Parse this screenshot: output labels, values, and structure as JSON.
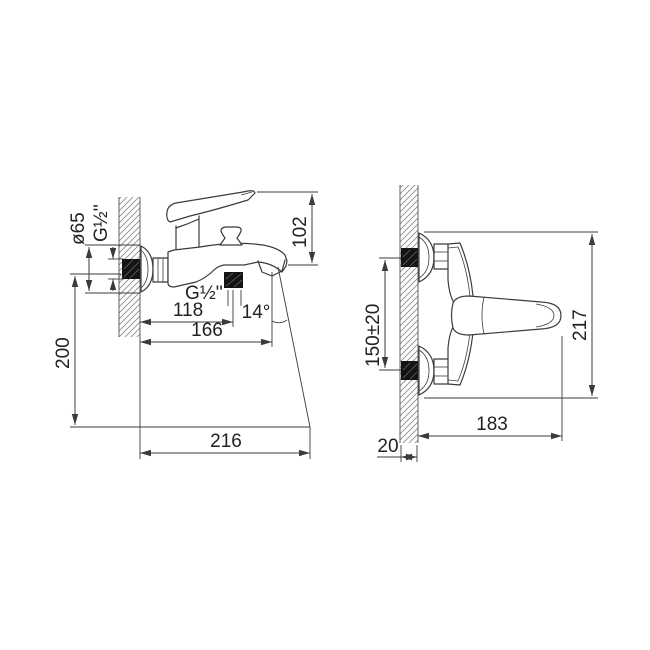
{
  "colors": {
    "background": "#ffffff",
    "line": "#3b3b3b",
    "text": "#222222",
    "hatch": "#8d8d8d",
    "solid_fill": "#141414"
  },
  "side_view": {
    "labels": {
      "flange_diameter": "ø65",
      "wall_thread": "G½''",
      "top_height": "102",
      "shower_thread": "G½''",
      "shower_offset": "118",
      "stream_angle": "14°",
      "spout_reach": "166",
      "mount_height": "200",
      "stream_reach": "216"
    }
  },
  "top_view": {
    "labels": {
      "connection_spacing": "150±20",
      "overall_length": "217",
      "wall_to_handle": "183",
      "wall_thickness": "20"
    }
  }
}
